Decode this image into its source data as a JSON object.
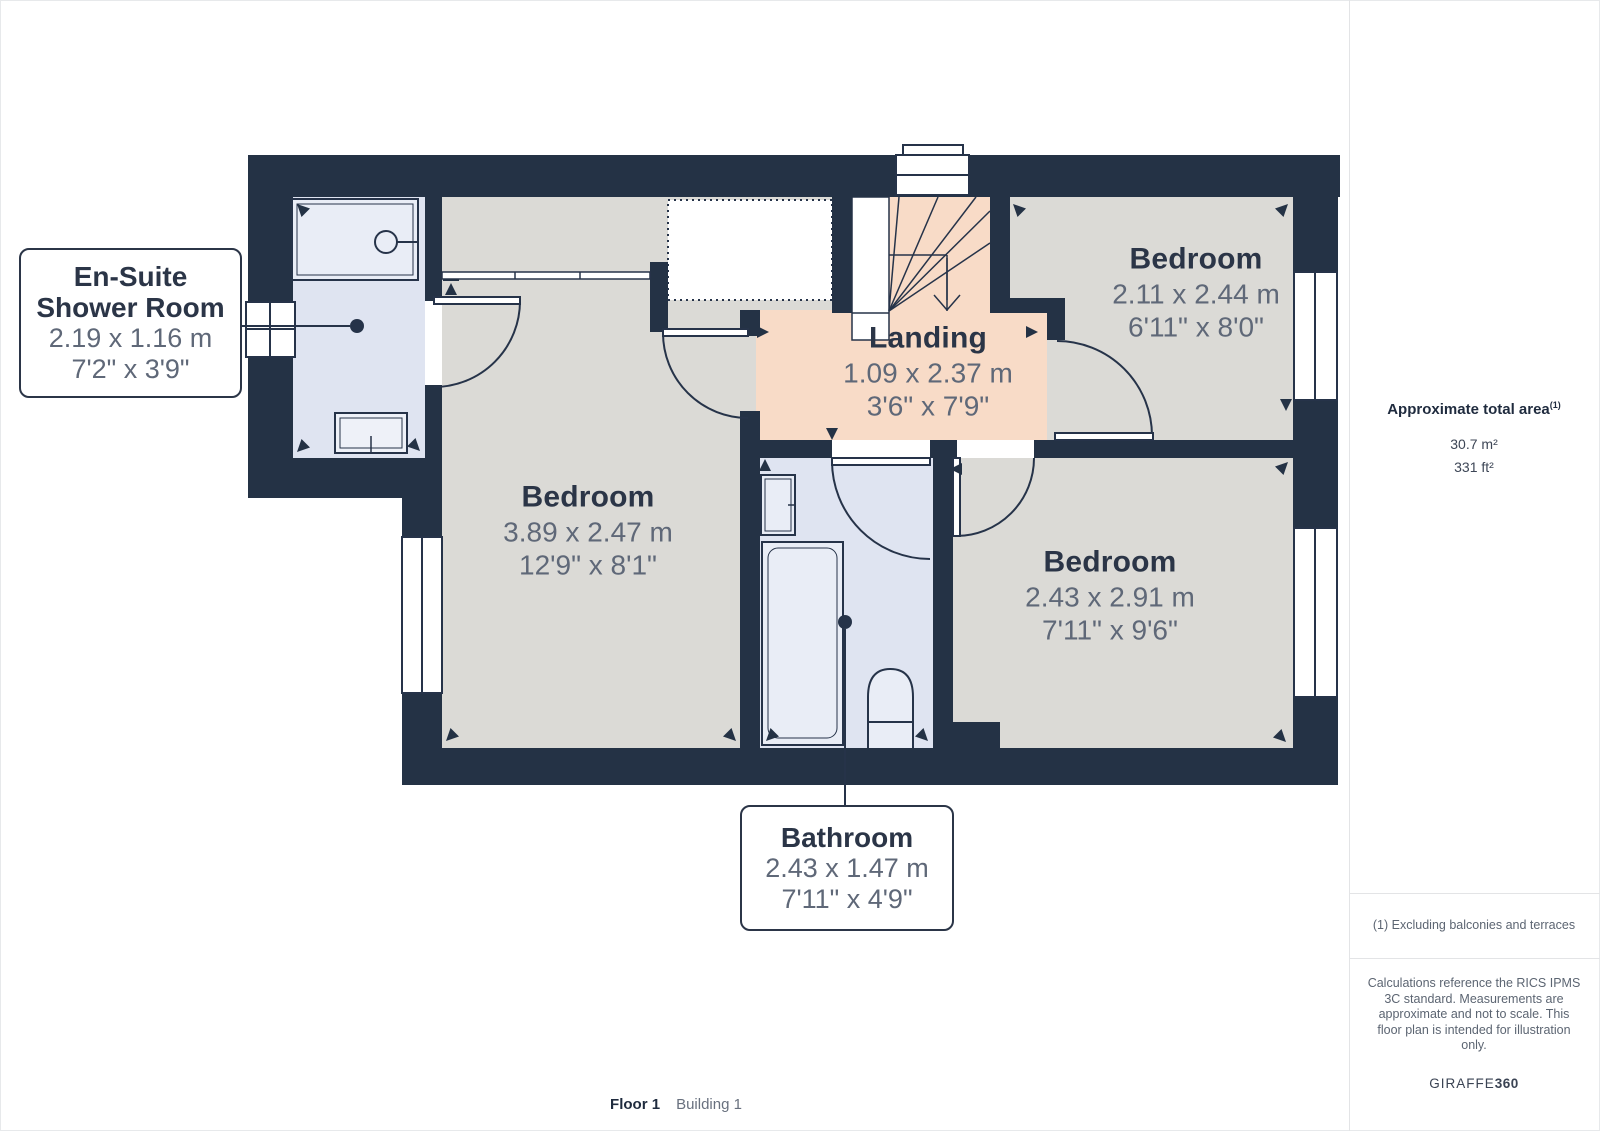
{
  "palette": {
    "wall": "#243245",
    "floor_grey": "#dbdad6",
    "floor_peach": "#f8dbc7",
    "floor_blue": "#dfe4f1",
    "fixture_fill": "#e9edf6",
    "line_dark": "#263349",
    "text_dark": "#2b3547",
    "text_dim": "#5f6878"
  },
  "plan": {
    "rooms": [
      {
        "key": "ensuite",
        "name_line1": "En-Suite",
        "name_line2": "Shower Room",
        "metric": "2.19 x 1.16 m",
        "imperial": "7'2\" x 3'9\""
      },
      {
        "key": "bedroom-main",
        "name": "Bedroom",
        "metric": "3.89 x 2.47 m",
        "imperial": "12'9\" x 8'1\""
      },
      {
        "key": "landing",
        "name": "Landing",
        "metric": "1.09 x 2.37 m",
        "imperial": "3'6\" x 7'9\""
      },
      {
        "key": "bedroom-top-right",
        "name": "Bedroom",
        "metric": "2.11 x 2.44 m",
        "imperial": "6'11\" x 8'0\""
      },
      {
        "key": "bedroom-bottom-right",
        "name": "Bedroom",
        "metric": "2.43 x 2.91 m",
        "imperial": "7'11\" x 9'6\""
      },
      {
        "key": "bathroom",
        "name": "Bathroom",
        "metric": "2.43 x 1.47 m",
        "imperial": "7'11\" x 4'9\""
      }
    ]
  },
  "sidebar": {
    "area_title": "Approximate total area",
    "area_title_sup": "(1)",
    "area_m2": "30.7 m²",
    "area_ft2": "331 ft²",
    "note": "(1) Excluding balconies and terraces",
    "disclaimer": "Calculations reference the RICS IPMS 3C standard. Measurements are approximate and not to scale. This floor plan is intended for illustration only.",
    "brand_name": "GIRAFFE",
    "brand_suffix": "360"
  },
  "footer": {
    "floor": "Floor 1",
    "building": "Building 1"
  }
}
